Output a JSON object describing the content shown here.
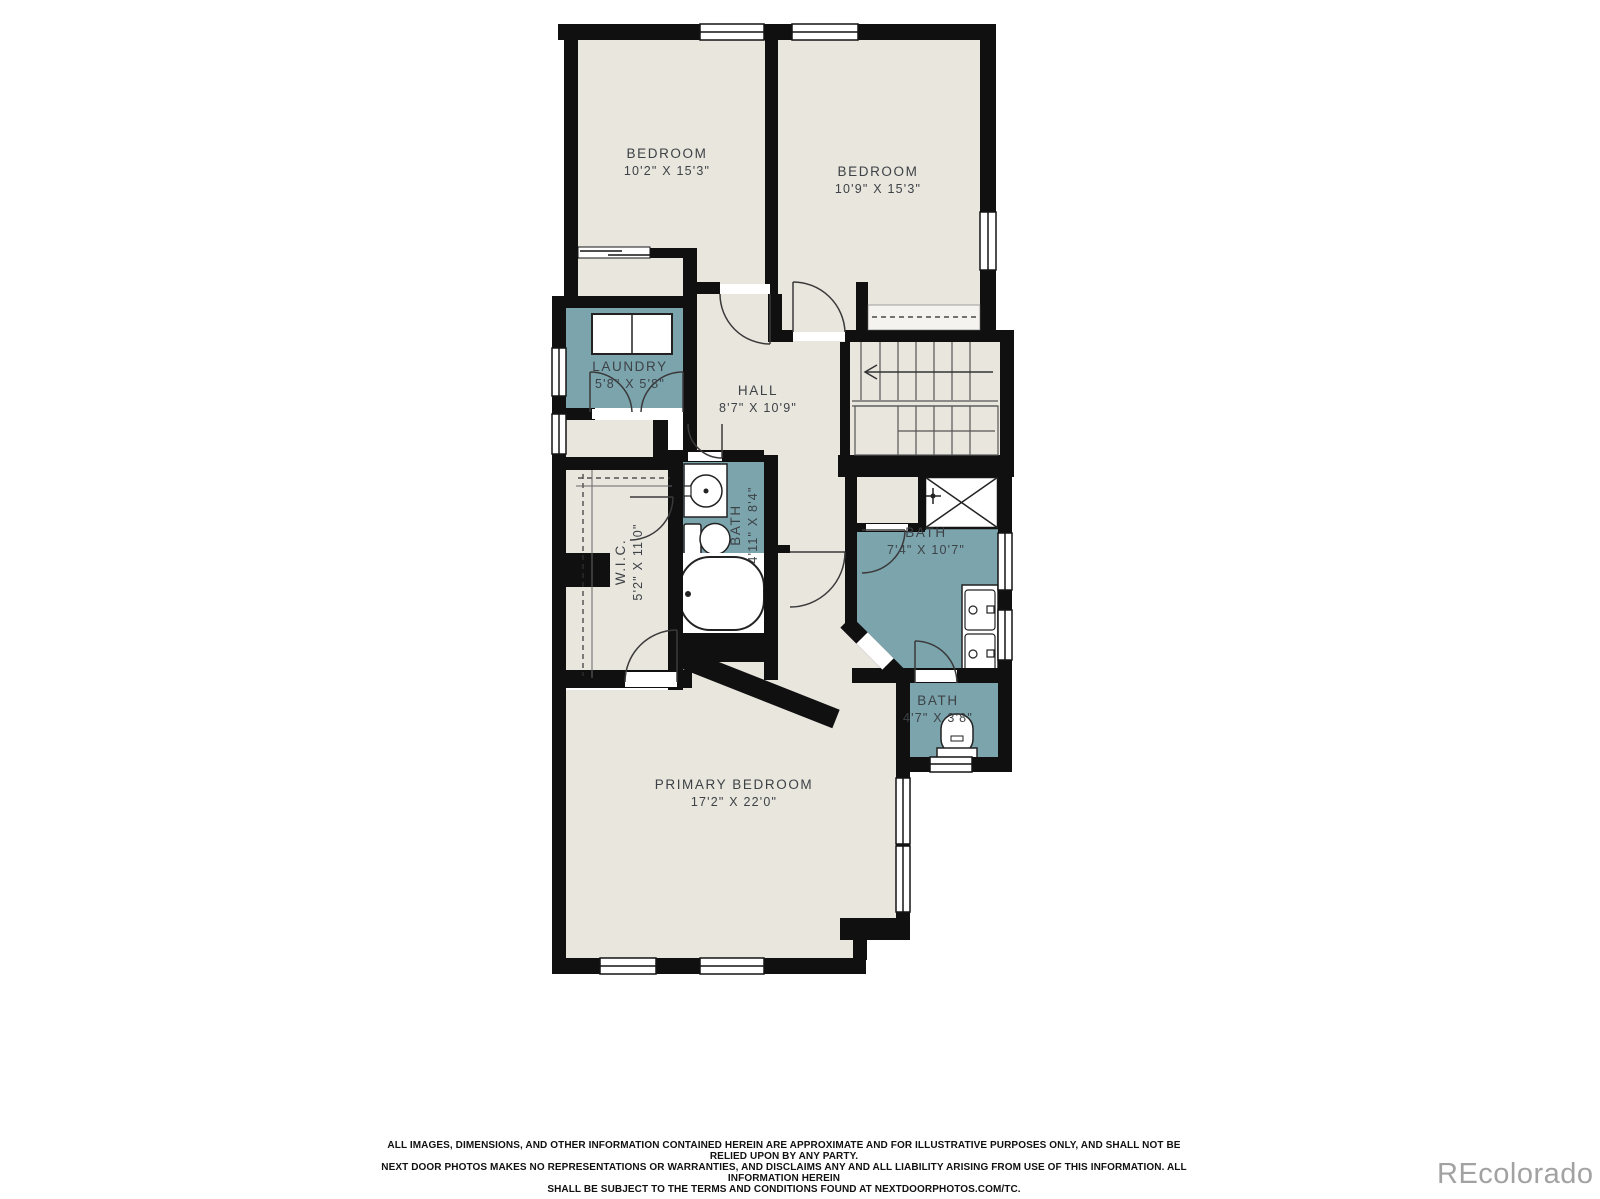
{
  "plan": {
    "rooms": [
      {
        "name": "BEDROOM",
        "dims": "10'2\" X 15'3\""
      },
      {
        "name": "BEDROOM",
        "dims": "10'9\" X 15'3\""
      },
      {
        "name": "LAUNDRY",
        "dims": "5'8\" X 5'8\""
      },
      {
        "name": "HALL",
        "dims": "8'7\" X 10'9\""
      },
      {
        "name": "BATH",
        "dims": "4'11\" X 8'4\""
      },
      {
        "name": "W.I.C.",
        "dims": "5'2\" X 11'0\""
      },
      {
        "name": "BATH",
        "dims": "7'4\" X 10'7\""
      },
      {
        "name": "BATH",
        "dims": "4'7\" X 3'8\""
      },
      {
        "name": "PRIMARY BEDROOM",
        "dims": "17'2\" X 22'0\""
      }
    ],
    "colors": {
      "wall": "#101010",
      "floor": "#e9e6de",
      "wet": "#7ba4ad",
      "fixture_fill": "#ffffff",
      "line": "#3a3a3a"
    }
  },
  "footer": {
    "disclaimer_line1": "ALL IMAGES, DIMENSIONS, AND OTHER INFORMATION CONTAINED HEREIN ARE APPROXIMATE AND FOR ILLUSTRATIVE PURPOSES ONLY, AND SHALL NOT BE RELIED UPON BY ANY PARTY.",
    "disclaimer_line2": "NEXT DOOR PHOTOS MAKES NO REPRESENTATIONS OR WARRANTIES, AND DISCLAIMS ANY AND ALL LIABILITY ARISING FROM USE OF THIS INFORMATION. ALL INFORMATION HEREIN",
    "disclaimer_line3": "SHALL BE SUBJECT TO THE TERMS AND CONDITIONS FOUND AT NEXTDOORPHOTOS.COM/TC.",
    "watermark": "REcolorado"
  }
}
